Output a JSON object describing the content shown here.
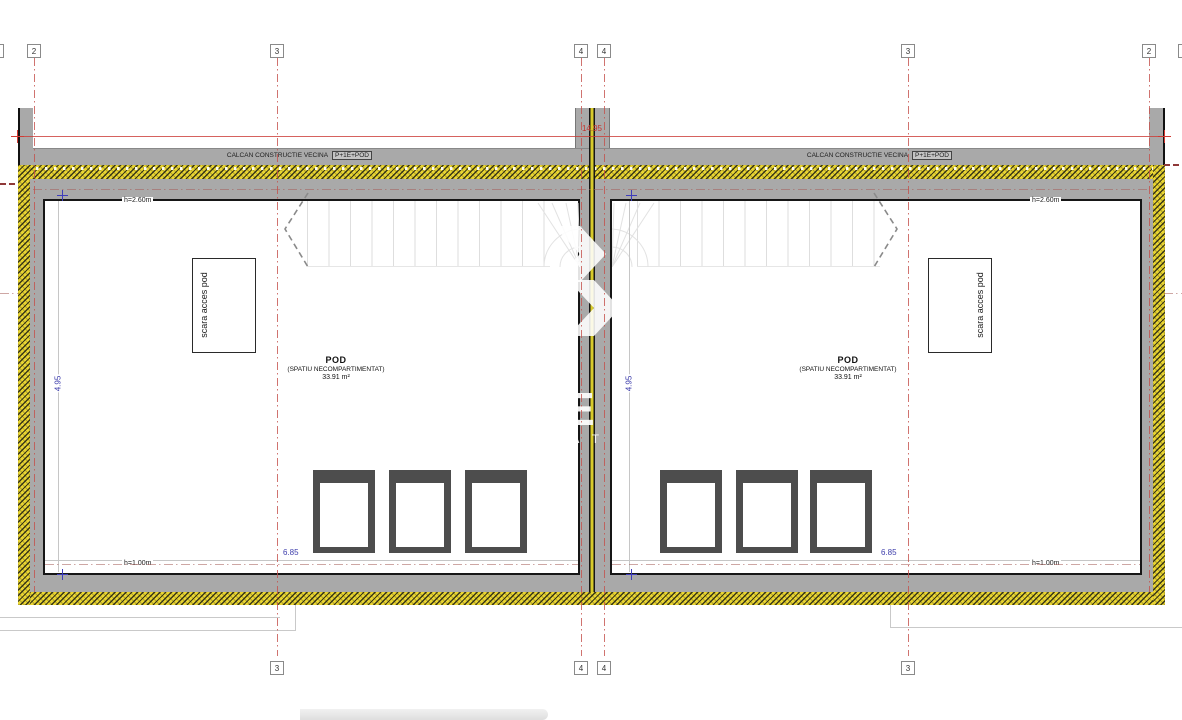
{
  "colors": {
    "wall_gray": "#a9a9a9",
    "insulation_yellow": "#e9d531",
    "axis_red": "#c4504b",
    "dimension_blue": "#3d3dab",
    "dimension_red": "#cc3b36",
    "line_black": "#161616"
  },
  "grid": {
    "top": [
      {
        "label": "2"
      },
      {
        "label": "3"
      },
      {
        "label": "4"
      },
      {
        "label": "4"
      },
      {
        "label": "3"
      },
      {
        "label": "2"
      }
    ],
    "bottom": [
      {
        "label": "3"
      },
      {
        "label": "4"
      },
      {
        "label": "4"
      },
      {
        "label": "3"
      }
    ]
  },
  "dimensions": {
    "total_width": "14.95",
    "unit_depth": "4.95",
    "unit_interior_width": "6.85"
  },
  "labels": {
    "calcan": "CALCAN CONSTRUCTIE VECINA",
    "calcan_badge": "P+1E+POD",
    "room_title": "POD",
    "room_subtitle": "(SPATIU NECOMPARTIMENTAT)",
    "room_area": "33.91 m²",
    "stair_box": "scara acces pod",
    "height_top": "h=2.60m",
    "height_bottom": "h=1.00m"
  },
  "watermark": {
    "letter": "E",
    "fragment": "C A T I"
  }
}
